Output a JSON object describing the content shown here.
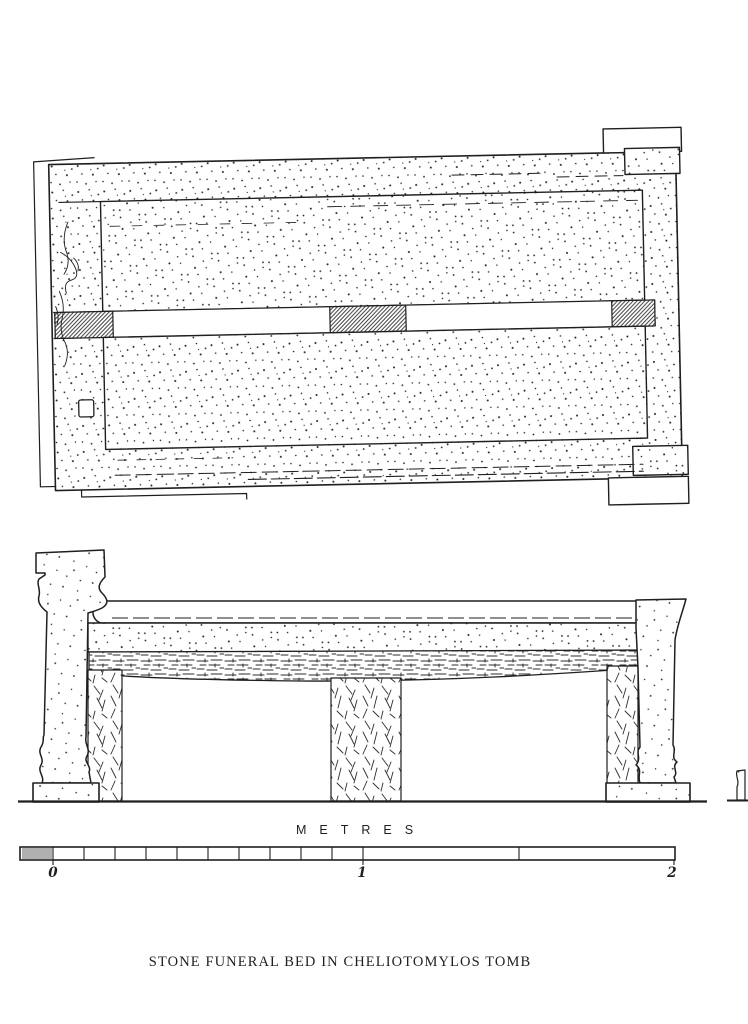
{
  "title": "STONE FUNERAL BED IN CHELIOTOMYLOS TOMB",
  "scale_bar": {
    "unit_label": "METRES",
    "ticks": [
      "0",
      "1",
      "2"
    ]
  },
  "colors": {
    "ink": "#1f1f1f",
    "paper": "#ffffff"
  }
}
